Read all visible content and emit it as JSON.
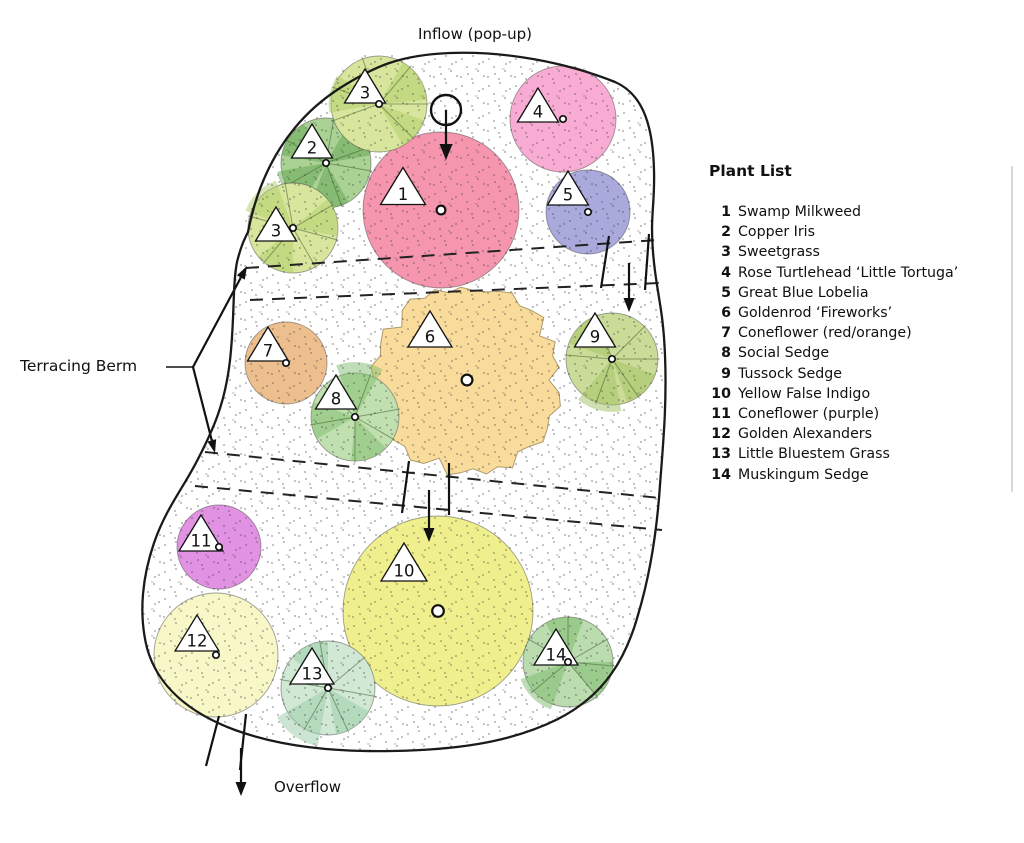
{
  "labels": {
    "inflow": "Inflow (pop-up)",
    "overflow": "Overflow",
    "terracing_berm": "Terracing Berm"
  },
  "plant_list": {
    "title": "Plant List",
    "items": [
      {
        "num": "1",
        "name": "Swamp Milkweed"
      },
      {
        "num": "2",
        "name": "Copper Iris"
      },
      {
        "num": "3",
        "name": "Sweetgrass"
      },
      {
        "num": "4",
        "name": "Rose Turtlehead ‘Little Tortuga’"
      },
      {
        "num": "5",
        "name": "Great Blue Lobelia"
      },
      {
        "num": "6",
        "name": "Goldenrod ‘Fireworks’"
      },
      {
        "num": "7",
        "name": "Coneflower (red/orange)"
      },
      {
        "num": "8",
        "name": "Social Sedge"
      },
      {
        "num": "9",
        "name": "Tussock Sedge"
      },
      {
        "num": "10",
        "name": "Yellow False Indigo"
      },
      {
        "num": "11",
        "name": "Coneflower (purple)"
      },
      {
        "num": "12",
        "name": "Golden Alexanders"
      },
      {
        "num": "13",
        "name": "Little Bluestem Grass"
      },
      {
        "num": "14",
        "name": "Muskingum Sedge"
      }
    ]
  },
  "colors": {
    "outline": "#1a1a1a",
    "dash": "#222222",
    "stipple": "#3c3c3c",
    "circle_stroke": "rgba(70,70,70,0.5)",
    "line_green": "rgba(70,95,50,0.55)",
    "rule": "#d8d8d8"
  },
  "bed": {
    "outline_path": "M 248 232 C 260 170 290 120 340 88 C 375 66 400 55 450 53 C 505 51 565 62 615 82 C 645 95 653 130 654 170 C 655 205 650 215 653 252 C 656 292 663 305 665 355 C 667 405 663 445 660 485 C 657 530 650 575 638 615 C 626 658 605 695 558 719 C 508 744 450 750 392 751 C 335 752 282 747 235 730 C 192 714 158 688 147 648 C 138 612 143 575 154 543 C 166 508 184 487 198 459 C 214 428 224 404 229 368 C 235 326 232 288 237 262 C 241 246 244 240 248 232 Z"
  },
  "plants": [
    {
      "num": "1",
      "cx": 441,
      "cy": 210,
      "r": 78,
      "fill": "#f596ae",
      "type": "plain",
      "tri": {
        "x": 403,
        "y": 186,
        "w": 45,
        "h": 37
      },
      "marker_r": 4.4
    },
    {
      "num": "2",
      "cx": 326,
      "cy": 163,
      "r": 45,
      "fill": "#abd295",
      "wedge_fill": "#5fa34f",
      "type": "grass",
      "wedges": [
        [
          190,
          240,
          1
        ],
        [
          60,
          110,
          1
        ],
        [
          300,
          350,
          1
        ],
        [
          120,
          170,
          1.1
        ]
      ],
      "line_angles": [
        10,
        70,
        150,
        210,
        280,
        340
      ],
      "tri": {
        "x": 312,
        "y": 141,
        "w": 41,
        "h": 34
      },
      "marker_r": 3.2
    },
    {
      "num": "3",
      "cx": 379,
      "cy": 104,
      "r": 48,
      "fill": "#d8e69d",
      "wedge_fill": "#aecb67",
      "type": "grass",
      "wedges": [
        [
          300,
          355,
          1
        ],
        [
          170,
          215,
          1.05
        ],
        [
          20,
          60,
          1
        ]
      ],
      "line_angles": [
        0,
        45,
        160,
        200,
        250,
        310
      ],
      "tri": {
        "x": 365,
        "y": 86,
        "w": 41,
        "h": 34
      },
      "marker_r": 3.2
    },
    {
      "num": "3",
      "cx": 293,
      "cy": 228,
      "r": 45,
      "fill": "#d8e69d",
      "wedge_fill": "#aecb67",
      "type": "grass",
      "wedges": [
        [
          200,
          250,
          1.12
        ],
        [
          320,
          370,
          1
        ],
        [
          90,
          140,
          1
        ]
      ],
      "line_angles": [
        15,
        60,
        130,
        195,
        260,
        330
      ],
      "tri": {
        "x": 276,
        "y": 224,
        "w": 41,
        "h": 34
      },
      "marker_r": 3.2
    },
    {
      "num": "4",
      "cx": 563,
      "cy": 119,
      "r": 53,
      "fill": "#f8acd4",
      "type": "plain",
      "tri": {
        "x": 538,
        "y": 105,
        "w": 41,
        "h": 34
      },
      "marker_r": 3.2
    },
    {
      "num": "5",
      "cx": 588,
      "cy": 212,
      "r": 42,
      "fill": "#a9a9dc",
      "type": "plain",
      "tri": {
        "x": 568,
        "y": 188,
        "w": 41,
        "h": 34
      },
      "marker_r": 3.2
    },
    {
      "num": "6",
      "cx": 467,
      "cy": 380,
      "r": 94,
      "fill": "#f9dc9b",
      "type": "ragged",
      "tri": {
        "x": 430,
        "y": 329,
        "w": 44,
        "h": 36
      },
      "marker_r": 5.4
    },
    {
      "num": "7",
      "cx": 286,
      "cy": 363,
      "r": 41,
      "fill": "#edbf8e",
      "type": "plain",
      "tri": {
        "x": 268,
        "y": 344,
        "w": 41,
        "h": 34
      },
      "marker_r": 3.2
    },
    {
      "num": "8",
      "cx": 355,
      "cy": 417,
      "r": 44,
      "fill": "#c1e0b0",
      "wedge_fill": "#7fbc6e",
      "type": "grass",
      "wedges": [
        [
          250,
          300,
          1.25
        ],
        [
          45,
          95,
          1
        ],
        [
          150,
          200,
          1
        ]
      ],
      "line_angles": [
        30,
        90,
        170,
        225,
        290,
        350
      ],
      "tri": {
        "x": 336,
        "y": 392,
        "w": 41,
        "h": 34
      },
      "marker_r": 3.2
    },
    {
      "num": "9",
      "cx": 612,
      "cy": 359,
      "r": 46,
      "fill": "#cadc97",
      "wedge_fill": "#9fc162",
      "type": "grass",
      "wedges": [
        [
          20,
          70,
          1
        ],
        [
          80,
          130,
          1.15
        ],
        [
          200,
          250,
          1
        ]
      ],
      "line_angles": [
        0,
        55,
        110,
        185,
        250,
        315
      ],
      "tri": {
        "x": 595,
        "y": 330,
        "w": 41,
        "h": 34
      },
      "marker_r": 3.2
    },
    {
      "num": "10",
      "cx": 438,
      "cy": 611,
      "r": 95,
      "fill": "#eff08d",
      "type": "plain",
      "tri": {
        "x": 404,
        "y": 562,
        "w": 46,
        "h": 38
      },
      "marker_r": 5.8
    },
    {
      "num": "11",
      "cx": 219,
      "cy": 547,
      "r": 42,
      "fill": "#e292e2",
      "type": "plain",
      "tri": {
        "x": 201,
        "y": 533,
        "w": 44,
        "h": 36
      },
      "marker_r": 3.2
    },
    {
      "num": "12",
      "cx": 216,
      "cy": 655,
      "r": 62,
      "fill": "#f8f7c8",
      "type": "plain",
      "tri": {
        "x": 197,
        "y": 633,
        "w": 44,
        "h": 36
      },
      "marker_r": 3.2
    },
    {
      "num": "13",
      "cx": 328,
      "cy": 688,
      "r": 47,
      "fill": "#d1e8d4",
      "wedge_fill": "#97cba6",
      "type": "grass",
      "wedges": [
        [
          30,
          80,
          1
        ],
        [
          100,
          150,
          1.25
        ],
        [
          220,
          270,
          1
        ]
      ],
      "line_angles": [
        10,
        65,
        120,
        190,
        260,
        320
      ],
      "tri": {
        "x": 312,
        "y": 666,
        "w": 44,
        "h": 36
      },
      "marker_r": 3.2
    },
    {
      "num": "14",
      "cx": 568,
      "cy": 662,
      "r": 45,
      "fill": "#badcae",
      "wedge_fill": "#7bb96a",
      "type": "grass",
      "wedges": [
        [
          0,
          50,
          1
        ],
        [
          110,
          160,
          1.12
        ],
        [
          240,
          290,
          1
        ]
      ],
      "line_angles": [
        5,
        50,
        140,
        210,
        270,
        330
      ],
      "tri": {
        "x": 556,
        "y": 647,
        "w": 44,
        "h": 36
      },
      "marker_r": 3.2
    }
  ],
  "berm_lines": [
    {
      "x1": 246,
      "y1": 268,
      "x2": 658,
      "y2": 240
    },
    {
      "x1": 250,
      "y1": 300,
      "x2": 660,
      "y2": 283
    },
    {
      "x1": 205,
      "y1": 452,
      "x2": 660,
      "y2": 498
    },
    {
      "x1": 195,
      "y1": 486,
      "x2": 662,
      "y2": 530
    }
  ],
  "ticks": [
    {
      "x1": 609,
      "y1": 236,
      "x2": 601,
      "y2": 288
    },
    {
      "x1": 649,
      "y1": 234,
      "x2": 645,
      "y2": 290
    },
    {
      "x1": 409,
      "y1": 461,
      "x2": 402,
      "y2": 513
    },
    {
      "x1": 449,
      "y1": 463,
      "x2": 449,
      "y2": 515
    },
    {
      "x1": 219,
      "y1": 716,
      "x2": 206,
      "y2": 766
    },
    {
      "x1": 246,
      "y1": 714,
      "x2": 240,
      "y2": 770
    }
  ],
  "flow_arrows": [
    {
      "x1": 446,
      "y1": 110,
      "x2": 446,
      "y2": 160,
      "L": 16,
      "W": 6.5
    },
    {
      "x1": 629,
      "y1": 263,
      "x2": 629,
      "y2": 312,
      "L": 14,
      "W": 5.5
    },
    {
      "x1": 429,
      "y1": 490,
      "x2": 429,
      "y2": 542,
      "L": 14,
      "W": 5.5
    },
    {
      "x1": 241,
      "y1": 748,
      "x2": 241,
      "y2": 796,
      "L": 14,
      "W": 5.5
    }
  ],
  "inflow_symbol": {
    "cx": 446,
    "cy": 110,
    "r": 15
  },
  "leader": {
    "stem": {
      "x1": 166,
      "y1": 367,
      "x2": 193,
      "y2": 367
    },
    "branches": [
      {
        "x1": 193,
        "y1": 367,
        "x2": 247,
        "y2": 266,
        "L": 13,
        "W": 4.5
      },
      {
        "x1": 193,
        "y1": 367,
        "x2": 215,
        "y2": 453,
        "L": 13,
        "W": 4.5
      }
    ]
  },
  "side_rule": {
    "x": 1012,
    "y1": 166,
    "y2": 492
  }
}
